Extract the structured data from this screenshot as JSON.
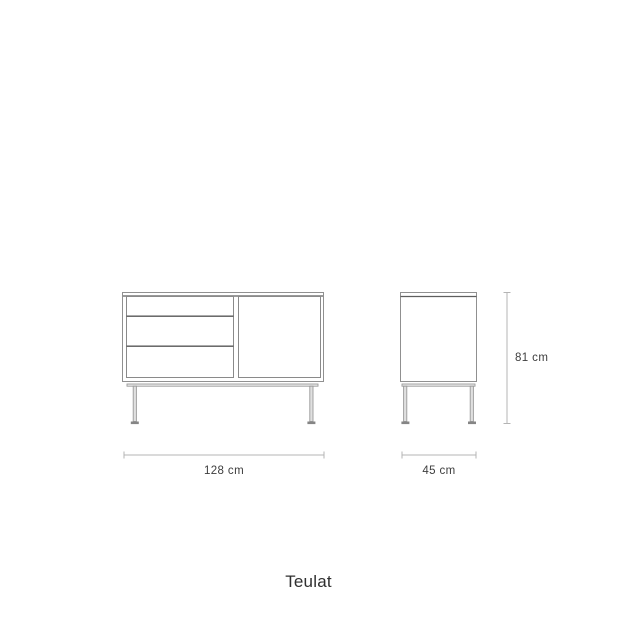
{
  "brand": {
    "name": "Teulat"
  },
  "dimensions": {
    "width_label": "128 cm",
    "depth_label": "45 cm",
    "height_label": "81 cm"
  },
  "colors": {
    "background": "#ffffff",
    "furniture_outline": "#909090",
    "furniture_detail_line": "#565656",
    "leg_fill": "#e0e0e0",
    "foot_fill": "#858585",
    "dimension_line": "#b4b4b4",
    "label_text": "#3d3d3d",
    "brand_text": "#2f2f2f"
  }
}
